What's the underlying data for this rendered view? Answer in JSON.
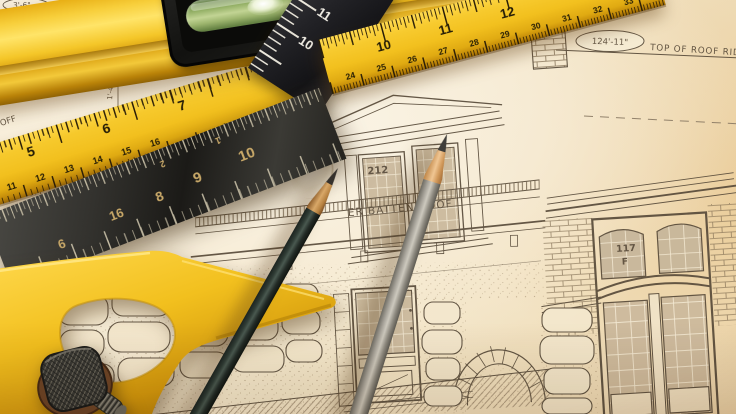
{
  "scene": {
    "description": "Architectural house-elevation blueprint on a desk with a yellow spirit level, yellow folding rulers, a black ruler, a steel combination-square rule with a yellow handle and knurled nut, and two drafting pencils"
  },
  "blueprint": {
    "ridge_dim": "124'-11\"",
    "ridge_label": "TOP OF ROOF RIDGE",
    "batten_label": "ER BATTEN ROOF",
    "dormer_window_tag": "212",
    "right_window_tag": "117",
    "right_window_sub": "F",
    "right_height_dim": "10'-10\"",
    "ceiling_label": "ROOM CEILING",
    "ceiling_dim": "1'-4\"",
    "left_dim": "7'-4\"",
    "corner_dim": "3'-6\"",
    "corner_label": "TOP",
    "edge_fragment_1": "OFF",
    "edge_fragment_2": "OM"
  },
  "tools": {
    "top_ruler": {
      "inch_marks": [
        "10",
        "11",
        "12"
      ],
      "fine_marks": [
        "24",
        "25",
        "26",
        "27",
        "28",
        "29",
        "30",
        "31",
        "32",
        "33"
      ]
    },
    "left_ruler": {
      "inch_marks": [
        "5",
        "6",
        "7"
      ],
      "fine_marks": [
        "11",
        "12",
        "13",
        "14",
        "15",
        "16"
      ]
    },
    "black_ruler": {
      "marks": [
        "10",
        "11",
        "12"
      ]
    },
    "steel_rule": {
      "marks": [
        "6",
        "16",
        "8",
        "9",
        "10",
        "2",
        "1"
      ]
    }
  },
  "colors": {
    "paper": "#f2e4c8",
    "paper_bright": "#faf4e6",
    "ink": "#574a39",
    "tool_yellow": "#f0c125",
    "steel_dark": "#2b2a27",
    "vial_green": "#9db36d",
    "pencil_dark_body": "#2d3831",
    "pencil_gray_body": "#a09c92",
    "pencil_wood": "#d29a5c"
  }
}
